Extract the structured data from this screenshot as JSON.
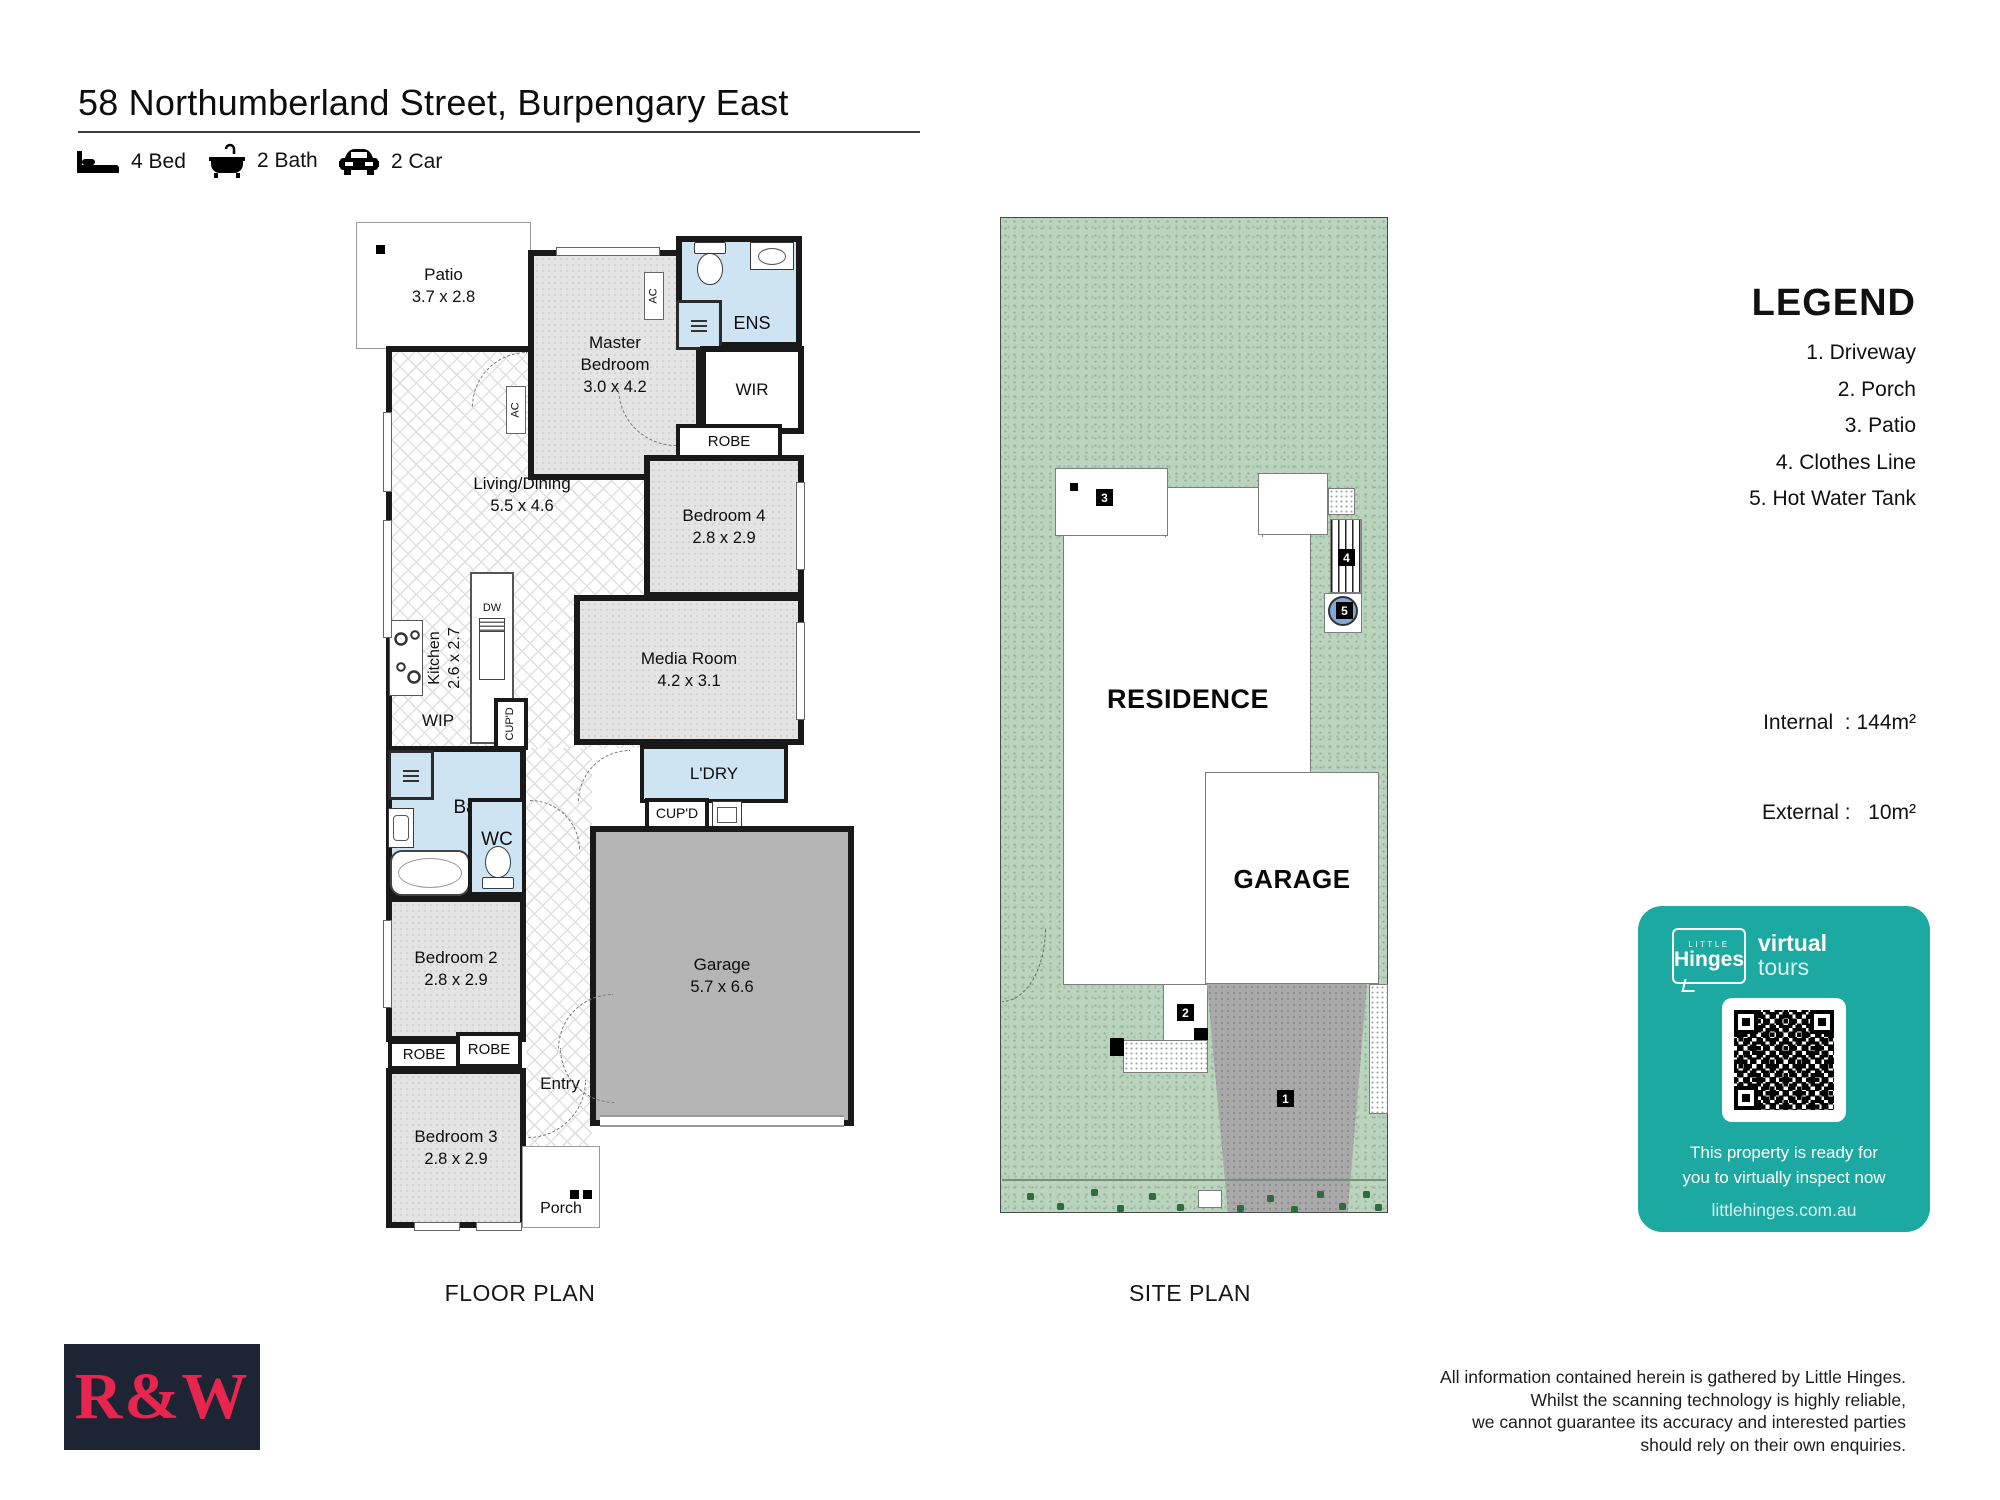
{
  "colors": {
    "accent": "#1BA9A1",
    "brand_red": "#E8254F",
    "brand_navy": "#1D2433",
    "lot_green": "#BAD4BD",
    "wet_blue": "#CFE4F2",
    "garage_grey": "#B5B5B5",
    "driveway_grey": "#A9A9A9"
  },
  "header": {
    "title": "58 Northumberland Street, Burpengary East",
    "bed_label": "4 Bed",
    "bath_label": "2 Bath",
    "car_label": "2 Car"
  },
  "floor_plan": {
    "caption": "FLOOR PLAN",
    "rooms": {
      "patio": {
        "label": "Patio",
        "dims": "3.7 x 2.8"
      },
      "master": {
        "label": "Master Bedroom",
        "dims": "3.0 x 4.2"
      },
      "ens": {
        "label": "ENS"
      },
      "wir": {
        "label": "WIR"
      },
      "robe_top": {
        "label": "ROBE"
      },
      "living": {
        "label": "Living/Dining",
        "dims": "5.5 x 4.6"
      },
      "bedroom4": {
        "label": "Bedroom 4",
        "dims": "2.8 x 2.9"
      },
      "media": {
        "label": "Media Room",
        "dims": "4.2 x 3.1"
      },
      "kitchen": {
        "label": "Kitchen",
        "dims": "2.6 x 2.7"
      },
      "dishwasher": {
        "label": "DW"
      },
      "wip": {
        "label": "WIP"
      },
      "cupd_kitchen": {
        "label": "CUP'D"
      },
      "bath": {
        "label": "Bath"
      },
      "wc": {
        "label": "WC"
      },
      "laundry": {
        "label": "L'DRY"
      },
      "cupd_laundry": {
        "label": "CUP'D"
      },
      "garage": {
        "label": "Garage",
        "dims": "5.7 x 6.6"
      },
      "bedroom2": {
        "label": "Bedroom 2",
        "dims": "2.8 x 2.9"
      },
      "robe_left": {
        "label": "ROBE"
      },
      "robe_right": {
        "label": "ROBE"
      },
      "bedroom3": {
        "label": "Bedroom 3",
        "dims": "2.8 x 2.9"
      },
      "entry": {
        "label": "Entry"
      },
      "porch": {
        "label": "Porch"
      },
      "ac_upper": {
        "label": "AC"
      },
      "ac_lower": {
        "label": "AC"
      }
    }
  },
  "site_plan": {
    "caption": "SITE PLAN",
    "residence_label": "RESIDENCE",
    "garage_label": "GARAGE",
    "marker_driveway": "1",
    "marker_porch": "2",
    "marker_patio": "3",
    "marker_clothes_line": "4",
    "marker_hot_water_tank": "5"
  },
  "legend": {
    "title": "LEGEND",
    "items": [
      "1. Driveway",
      "2. Porch",
      "3. Patio",
      "4. Clothes Line",
      "5. Hot Water Tank"
    ]
  },
  "areas": {
    "internal": "Internal  : 144m²",
    "external": "External :   10m²"
  },
  "virtual_tour_card": {
    "brand_top": "LITTLE",
    "brand_name": "Hinges",
    "brand_virtual": "virtual",
    "brand_tours": "tours",
    "message_line1": "This property is ready for",
    "message_line2": "you to virtually inspect now",
    "website": "littlehinges.com.au"
  },
  "footer": {
    "agency_logo": "R&W",
    "disclaimer": [
      "All information contained herein is gathered by Little Hinges.",
      "Whilst the scanning technology is highly reliable,",
      "we cannot guarantee its accuracy and interested parties",
      "should rely on their own enquiries."
    ]
  }
}
